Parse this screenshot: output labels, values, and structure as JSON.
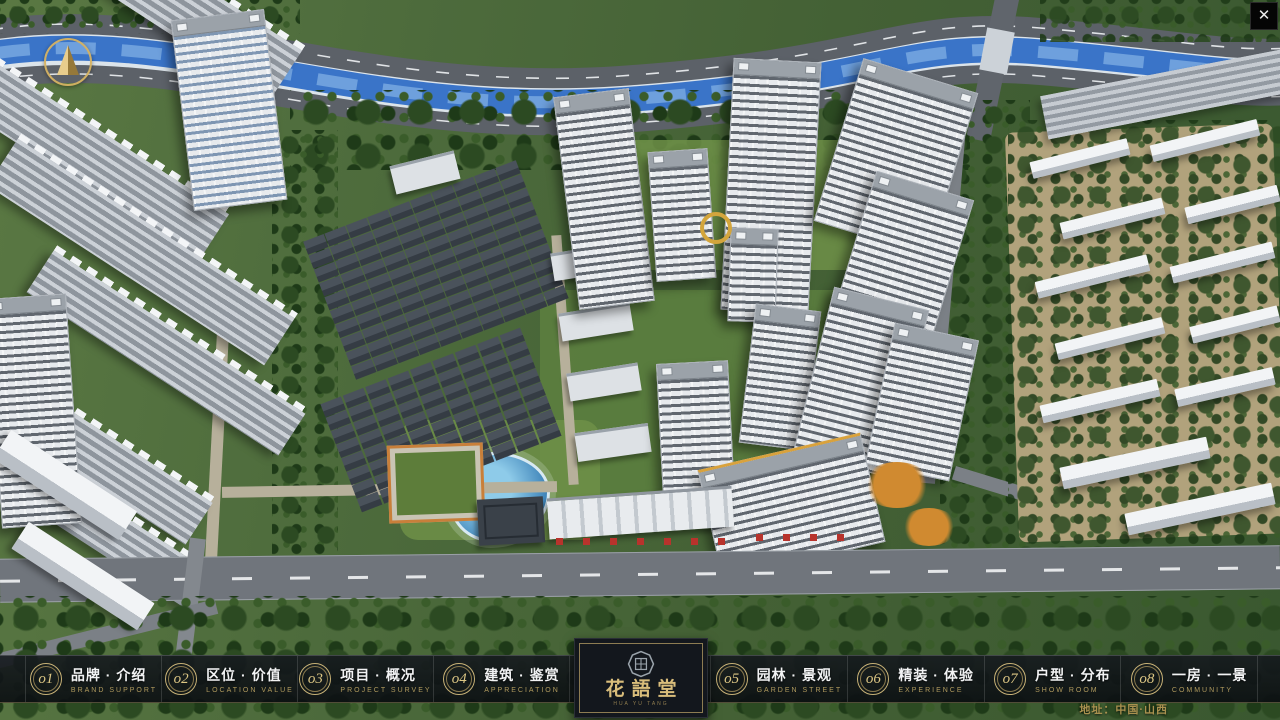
{
  "window": {
    "close_glyph": "✕"
  },
  "logo": {
    "title": "花語堂",
    "subtitle": "HUA YU TANG"
  },
  "footer": {
    "address": "地址：中国·山西"
  },
  "nav": {
    "items": [
      {
        "num": "o1",
        "label": "品牌 · 介绍",
        "sub": "BRAND SUPPORT"
      },
      {
        "num": "o2",
        "label": "区位 · 价值",
        "sub": "LOCATION VALUE"
      },
      {
        "num": "o3",
        "label": "项目 · 概况",
        "sub": "PROJECT SURVEY"
      },
      {
        "num": "o4",
        "label": "建筑 · 鉴赏",
        "sub": "APPRECIATION"
      },
      {
        "num": "o5",
        "label": "园林 · 景观",
        "sub": "GARDEN STREET"
      },
      {
        "num": "o6",
        "label": "精装 · 体验",
        "sub": "EXPERIENCE"
      },
      {
        "num": "o7",
        "label": "户型 · 分布",
        "sub": "SHOW ROOM"
      },
      {
        "num": "o8",
        "label": "一房 · 一景",
        "sub": "COMMUNITY"
      }
    ]
  },
  "colors": {
    "gold_accent": "#c9ab66",
    "bar_background": "#12161b",
    "river_blue": "#3a74c8",
    "site_green": "#4d6b3c"
  }
}
